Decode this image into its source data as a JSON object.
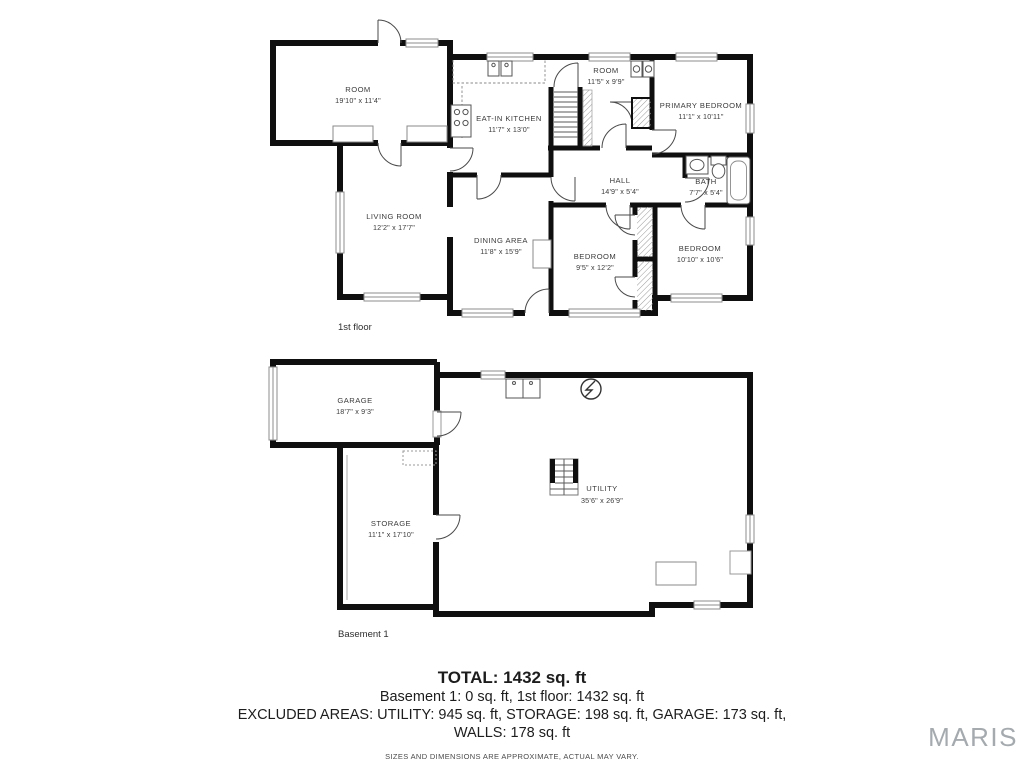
{
  "first_floor": {
    "label": "1st floor",
    "rooms": {
      "room_top_left": {
        "name": "ROOM",
        "dims": "19'10\" x 11'4\""
      },
      "kitchen": {
        "name": "EAT-IN KITCHEN",
        "dims": "11'7\" x 13'0\""
      },
      "room_center": {
        "name": "ROOM",
        "dims": "11'5\" x 9'9\""
      },
      "primary_bedroom": {
        "name": "PRIMARY BEDROOM",
        "dims": "11'1\" x 10'11\""
      },
      "living_room": {
        "name": "LIVING ROOM",
        "dims": "12'2\" x 17'7\""
      },
      "dining_area": {
        "name": "DINING AREA",
        "dims": "11'8\" x 15'9\""
      },
      "hall": {
        "name": "HALL",
        "dims": "14'9\" x 5'4\""
      },
      "bath": {
        "name": "BATH",
        "dims": "7'7\" x 5'4\""
      },
      "bedroom_left": {
        "name": "BEDROOM",
        "dims": "9'5\" x 12'2\""
      },
      "bedroom_right": {
        "name": "BEDROOM",
        "dims": "10'10\" x 10'6\""
      }
    }
  },
  "basement": {
    "label": "Basement 1",
    "rooms": {
      "garage": {
        "name": "GARAGE",
        "dims": "18'7\" x 9'3\""
      },
      "storage": {
        "name": "STORAGE",
        "dims": "11'1\" x 17'10\""
      },
      "utility": {
        "name": "UTILITY",
        "dims": "35'6\" x 26'9\""
      }
    }
  },
  "summary": {
    "total": "TOTAL: 1432 sq. ft",
    "floors_line": "Basement 1: 0 sq. ft, 1st floor: 1432 sq. ft",
    "excluded_line": "EXCLUDED AREAS: UTILITY: 945 sq. ft, STORAGE: 198 sq. ft, GARAGE: 173 sq. ft,",
    "walls_line": "WALLS: 178 sq. ft",
    "disclaimer": "SIZES AND DIMENSIONS ARE APPROXIMATE, ACTUAL MAY VARY."
  },
  "logo": "MARIS",
  "colors": {
    "wall": "#0f0f0f",
    "window_frame": "#8c8c8c",
    "fixture": "#555555",
    "logo_gray": "#a5aaaf"
  }
}
